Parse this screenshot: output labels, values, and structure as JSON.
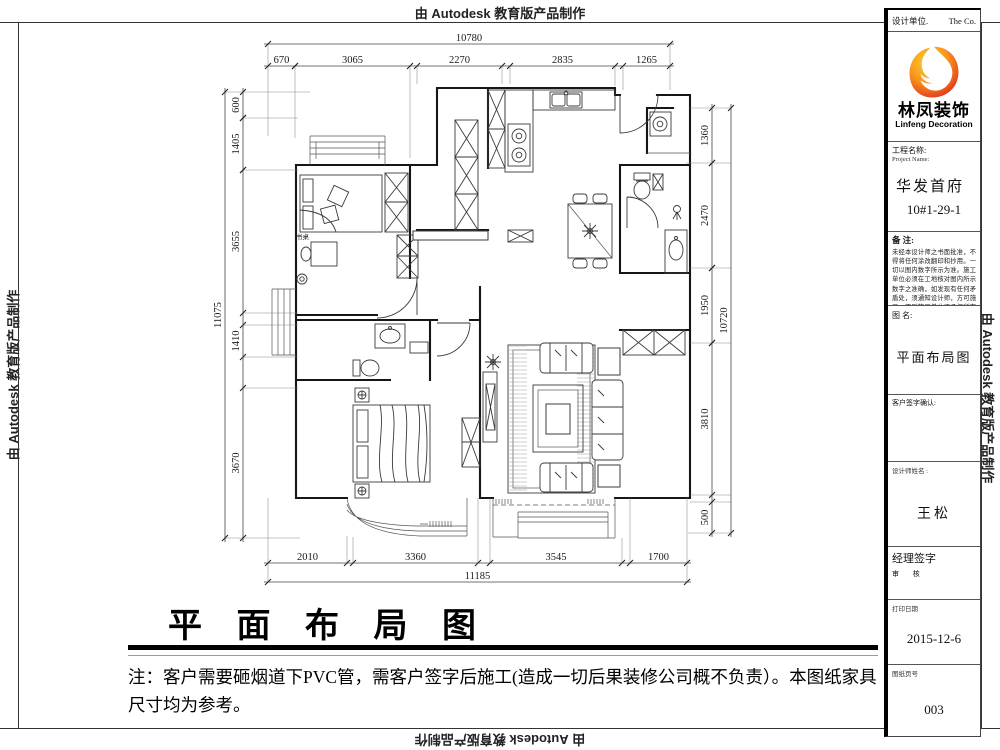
{
  "stamp": {
    "text": "由 Autodesk 教育版产品制作"
  },
  "title_block": {
    "design_unit_label": "设计单位.",
    "design_unit_value": "The  Co.",
    "logo": {
      "cn": "林凤装饰",
      "en": "Linfeng Decoration"
    },
    "project_label_cn": "工程名称:",
    "project_label_en": "Project Name:",
    "project_name": "华发首府",
    "project_no": "10#1-29-1",
    "notes_label": "备  注:",
    "notes_text": "未经本设计师之书面批准，不得将任何涂改翻印和抄用。一切以图内数字所示为准。施工单位必须在工地核对图内所示数字之准确，如发现有任何矛盾处，须通知设计师，方可施工，否则施工单位须承担所有责任。",
    "drawing_name_label": "图  名:",
    "drawing_name": "平面布局图",
    "client_sign_label": "客户签字确认:",
    "designer_label": "设计师姓名 :",
    "designer_name": "王松",
    "manager_sign_label": "经理签字",
    "review_label": "审  核",
    "print_date_label": "打印日期",
    "print_date": "2015-12-6",
    "sheet_no_label": "图纸页号",
    "sheet_no": "003"
  },
  "footer": {
    "title": "平 面 布 局 图",
    "note": "注：客户需要砸烟道下PVC管，需客户签字后施工(造成一切后果装修公司概不负责）。本图纸家具尺寸均为参考。"
  },
  "plan": {
    "desk_label": "书桌",
    "dims": {
      "top_total": "10780",
      "top": [
        "670",
        "3065",
        "2270",
        "2835",
        "1265"
      ],
      "left_total": "11075",
      "left": [
        "600",
        "1405",
        "3655",
        "1410",
        "3670"
      ],
      "right_total": "10720",
      "right": [
        "1360",
        "2470",
        "1950",
        "3810",
        "500"
      ],
      "bottom_total": "11185",
      "bottom": [
        "2010",
        "3360",
        "3545",
        "1700"
      ]
    }
  }
}
